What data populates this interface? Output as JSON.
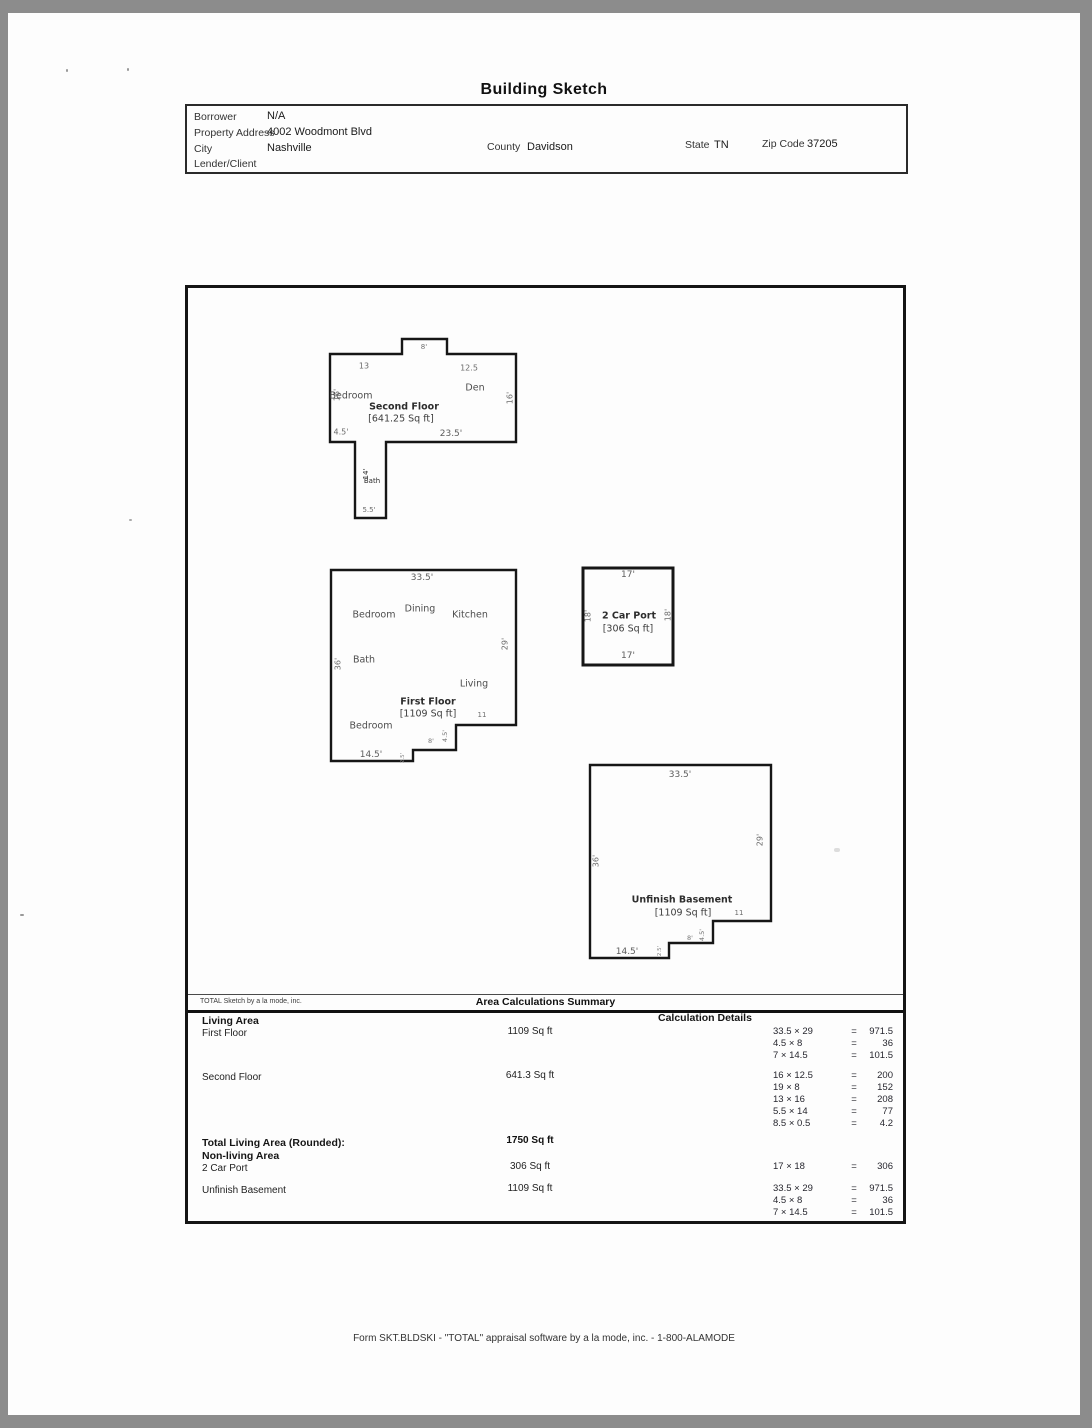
{
  "doc": {
    "title": "Building Sketch",
    "footer": "Form SKT.BLDSKI - \"TOTAL\" appraisal software by a la mode, inc. - 1-800-ALAMODE"
  },
  "header": {
    "borrower": {
      "label": "Borrower",
      "value": "N/A"
    },
    "property_address": {
      "label": "Property Address",
      "value": "4002 Woodmont Blvd"
    },
    "city": {
      "label": "City",
      "value": "Nashville"
    },
    "county": {
      "label": "County",
      "value": "Davidson"
    },
    "state": {
      "label": "State",
      "value": "TN"
    },
    "zip": {
      "label": "Zip Code",
      "value": "37205"
    },
    "lender": {
      "label": "Lender/Client",
      "value": ""
    }
  },
  "sketch": {
    "second_floor": {
      "title": "Second Floor",
      "area": "[641.25 Sq ft]",
      "bedroom": "Bedroom",
      "den": "Den",
      "bath": "Bath",
      "dim_top_left": "13",
      "dim_bump": "8'",
      "dim_top_right": "12.5",
      "dim_left": "16'",
      "dim_right": "16'",
      "dim_bottom_left": "4.5'",
      "dim_bottom": "23.5'",
      "dim_wing_side": "14'",
      "dim_wing_bottom": "5.5'"
    },
    "first_floor": {
      "title": "First Floor",
      "area": "[1109 Sq ft]",
      "bedroom_top": "Bedroom",
      "dining": "Dining",
      "kitchen": "Kitchen",
      "bath": "Bath",
      "living": "Living",
      "bedroom_bottom": "Bedroom",
      "dim_top": "33.5'",
      "dim_left": "36'",
      "dim_right": "29'",
      "dim_step_run": "11",
      "dim_step_rise": "4.5'",
      "dim_step_run2": "8'",
      "dim_step_rise2": "2.5'",
      "dim_bottom": "14.5'"
    },
    "car_port": {
      "title": "2 Car Port",
      "area": "[306 Sq ft]",
      "dim_top": "17'",
      "dim_bottom": "17'",
      "dim_left": "18'",
      "dim_right": "18'"
    },
    "basement": {
      "title": "Unfinish Basement",
      "area": "[1109 Sq ft]",
      "dim_top": "33.5'",
      "dim_left": "36'",
      "dim_right": "29'",
      "dim_step_run": "11",
      "dim_step_rise": "4.5'",
      "dim_step_run2": "8'",
      "dim_step_rise2": "2.5'",
      "dim_bottom": "14.5'"
    }
  },
  "summary": {
    "brand": "TOTAL Sketch by a la mode, inc.",
    "title": "Area Calculations Summary",
    "living_label": "Living Area",
    "details_label": "Calculation Details",
    "equals": "=",
    "living_rows": [
      {
        "name": "First Floor",
        "area": "1109 Sq ft",
        "calcs": [
          {
            "expr": "33.5 × 29",
            "result": "971.5"
          },
          {
            "expr": "4.5 × 8",
            "result": "36"
          },
          {
            "expr": "7 × 14.5",
            "result": "101.5"
          }
        ]
      },
      {
        "name": "Second Floor",
        "area": "641.3 Sq ft",
        "calcs": [
          {
            "expr": "16 × 12.5",
            "result": "200"
          },
          {
            "expr": "19 × 8",
            "result": "152"
          },
          {
            "expr": "13 × 16",
            "result": "208"
          },
          {
            "expr": "5.5 × 14",
            "result": "77"
          },
          {
            "expr": "8.5 × 0.5",
            "result": "4.2"
          }
        ]
      }
    ],
    "total_label": "Total Living Area (Rounded):",
    "total_value": "1750 Sq ft",
    "nonliving_label": "Non-living Area",
    "nonliving_rows": [
      {
        "name": "2 Car Port",
        "area": "306 Sq ft",
        "calcs": [
          {
            "expr": "17 × 18",
            "result": "306"
          }
        ]
      },
      {
        "name": "Unfinish Basement",
        "area": "1109 Sq ft",
        "calcs": [
          {
            "expr": "33.5 × 29",
            "result": "971.5"
          },
          {
            "expr": "4.5 × 8",
            "result": "36"
          },
          {
            "expr": "7 × 14.5",
            "result": "101.5"
          }
        ]
      }
    ]
  }
}
